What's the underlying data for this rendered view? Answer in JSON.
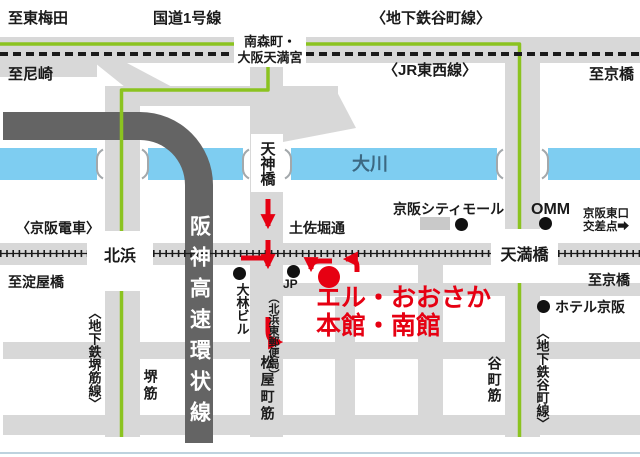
{
  "map_description": "Access map to L-Osaka (Osaka) with subway, JR and Keihan lines",
  "colors": {
    "road_gray": "#d8d8d8",
    "expressway_gray": "#646464",
    "river_blue": "#7ecdf1",
    "subway_green": "#8bc320",
    "route_red": "#e60012",
    "rail_black": "#1a1a1a",
    "building_gray": "#c9c9c9",
    "river_label_blue": "#3c6882",
    "bottom_frame": "#bdd2de"
  },
  "labels": {
    "to_higashi_umeda": "至東梅田",
    "route1": "国道1号線",
    "subway_tanimachi_top": "〈地下鉄谷町線〉",
    "minamimorimachi_line1": "南森町・",
    "minamimorimachi_line2": "大阪天満宮",
    "to_amagasaki": "至尼崎",
    "jr_tozai": "〈JR東西線〉",
    "to_kyobashi_top": "至京橋",
    "okawa": "大川",
    "tenjinbashi": "天神橋",
    "keihan_railway": "〈京阪電車〉",
    "tosabori": "土佐堀通",
    "kitahama": "北浜",
    "to_yodoyabashi": "至淀屋橋",
    "keihan_city_mall": "京阪シティモール",
    "omm": "OMM",
    "keihan_east_exit_line1": "京阪東口",
    "keihan_east_exit_line2": "交差点➡",
    "temmabashi": "天満橋",
    "to_kyobashi_mid": "至京橋",
    "hotel_keihan": "ホテル京阪",
    "obayashi_bldg": "大林ビル",
    "jp_post_prefix": "JP",
    "jp_post_name": "（北浜東郵便局）",
    "l_osaka_line1": "エル・おおさか",
    "l_osaka_line2": "本館・南館",
    "hanshin_expressway": "阪神高速環状線",
    "sakaisuji_line": "〈地下鉄堺筋線〉",
    "sakai_suji": "堺筋",
    "matsuyamachi_suji": "松屋町筋",
    "tanimachi_suji": "谷町筋",
    "subway_tanimachi_bottom": "〈地下鉄谷町線〉"
  }
}
